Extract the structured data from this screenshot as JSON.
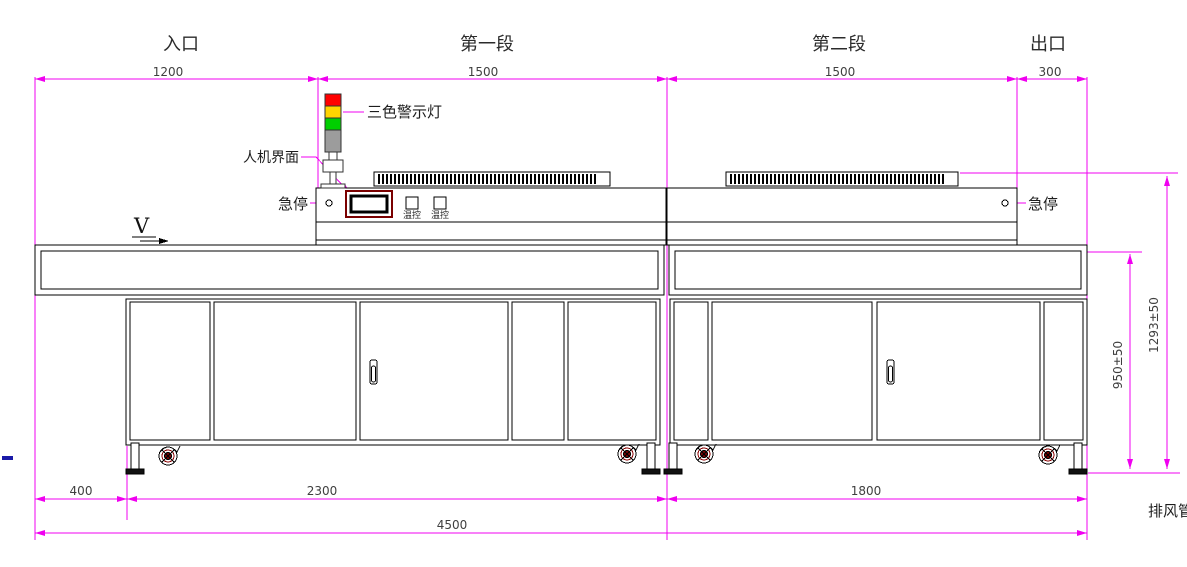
{
  "drawing": {
    "title_context": "conveyor oven side-view engineering drawing",
    "sections": [
      {
        "name": "entrance",
        "label": "入口",
        "width_mm": "1200"
      },
      {
        "name": "section1",
        "label": "第一段",
        "width_mm": "1500"
      },
      {
        "name": "section2",
        "label": "第二段",
        "width_mm": "1500"
      },
      {
        "name": "exit",
        "label": "出口",
        "width_mm": "300"
      }
    ],
    "footprint": {
      "front_offset": "400",
      "unit1_base": "2300",
      "unit2_base": "1800",
      "total_length": "4500"
    },
    "heights": {
      "belt_height": "950±50",
      "overall_height": "1293±50"
    },
    "callouts": {
      "tower_light": "三色警示灯",
      "hmi": "人机界面",
      "estop": "急停",
      "temp_controller": "温控",
      "exhaust_duct": "排风管",
      "direction": "V"
    },
    "colors": {
      "dimension_line": "#f000f0",
      "outline": "#000000",
      "dim_text": "#3f3f3f",
      "tower_red": "#ff0000",
      "tower_yellow": "#ffd400",
      "tower_green": "#00cf00",
      "tower_base_gray": "#9c9c9c",
      "hmi_frame": "#7a0000",
      "caster_hub": "#7a0000",
      "margin_mark_blue": "#1a1aa8"
    }
  }
}
